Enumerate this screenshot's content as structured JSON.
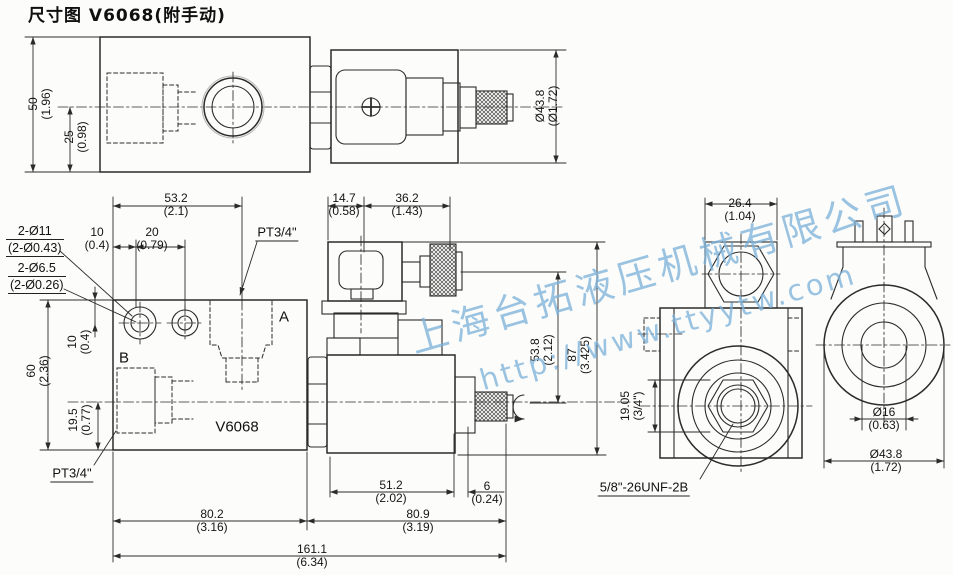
{
  "title": "尺寸图 V6068(附手动)",
  "watermark": {
    "company": "上海台拓液压机械有限公司",
    "url": "http://www.ttyytw.com",
    "color": "#7eb2da"
  },
  "labels": {
    "port_a": "A",
    "port_b": "B",
    "model": "V6068",
    "pt34_top": "PT3/4\"",
    "pt34_bottom": "PT3/4\"",
    "holes_large": "2-Ø11",
    "holes_large_in": "(2-Ø0.43)",
    "holes_small": "2-Ø6.5",
    "holes_small_in": "(2-Ø0.26)",
    "thread": "5/8\"-26UNF-2B"
  },
  "dims": {
    "h50": {
      "v": "50",
      "i": "(1.96)"
    },
    "h25": {
      "v": "25",
      "i": "(0.98)"
    },
    "dia438_top": {
      "v": "Ø43.8",
      "i": "(Ø1.72)"
    },
    "w532": {
      "v": "53.2",
      "i": "(2.1)"
    },
    "w10": {
      "v": "10",
      "i": "(0.4)"
    },
    "w20": {
      "v": "20",
      "i": "(0.79)"
    },
    "h60": {
      "v": "60",
      "i": "(2.36)"
    },
    "h10": {
      "v": "10",
      "i": "(0.4)"
    },
    "h195": {
      "v": "19.5",
      "i": "(0.77)"
    },
    "w147": {
      "v": "14.7",
      "i": "(0.58)"
    },
    "w362": {
      "v": "36.2",
      "i": "(1.43)"
    },
    "h538": {
      "v": "53.8",
      "i": "(2.12)"
    },
    "h87": {
      "v": "87",
      "i": "(3.425)"
    },
    "w512": {
      "v": "51.2",
      "i": "(2.02)"
    },
    "w6": {
      "v": "6",
      "i": "(0.24)"
    },
    "w802": {
      "v": "80.2",
      "i": "(3.16)"
    },
    "w809": {
      "v": "80.9",
      "i": "(3.19)"
    },
    "w1611": {
      "v": "161.1",
      "i": "(6.34)"
    },
    "w264": {
      "v": "26.4",
      "i": "(1.04)"
    },
    "h1905": {
      "v": "19.05",
      "i": "(3/4\")"
    },
    "dia16": {
      "v": "Ø16",
      "i": "(0.63)"
    },
    "dia438_r": {
      "v": "Ø43.8",
      "i": "(1.72)"
    }
  }
}
